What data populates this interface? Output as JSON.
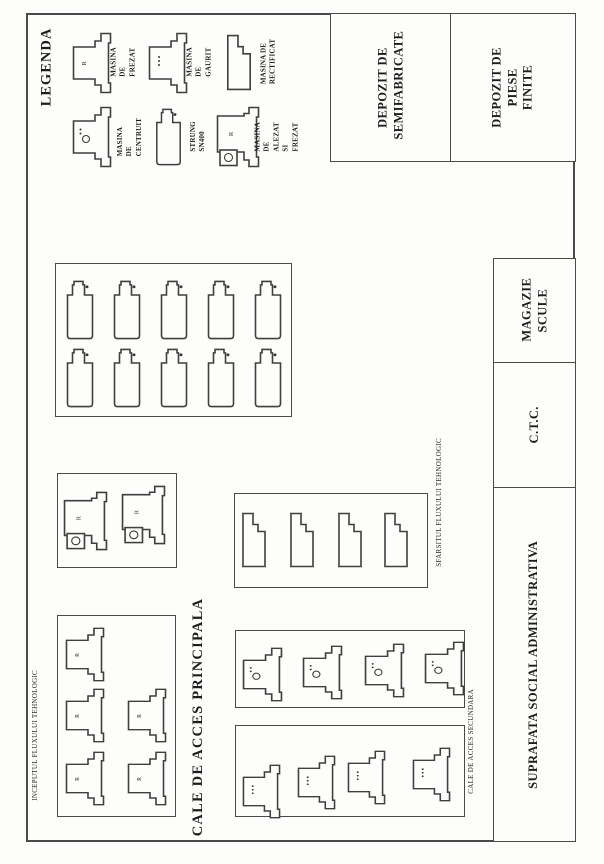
{
  "legend": {
    "title": "LEGENDA",
    "items": [
      {
        "type": "frezat",
        "label": "MASINA DE FREZAT"
      },
      {
        "type": "gaurit",
        "label": "MASINA DE GAURIT"
      },
      {
        "type": "rectificat",
        "label": "MASINA DE RECTIFICAT"
      },
      {
        "type": "centruit",
        "label": "MASINA DE CENTRUIT"
      },
      {
        "type": "strung",
        "label": "STRUNG SN400"
      },
      {
        "type": "alezat",
        "label": "MASINA DE ALEZAT SI FREZAT"
      }
    ]
  },
  "rooms": {
    "depozit_semifabricate": "DEPOZIT DE SEMIFABRICATE",
    "depozit_piese_finite": "DEPOZIT DE PIESE FINITE",
    "magazie_scule": "MAGAZIE SCULE",
    "ctc": "C.T.C.",
    "suprafata_social": "SUPRAFATA SOCIAL ADMINISTRATIVA"
  },
  "annotations": {
    "inceputul_fluxului": "INCEPUTUL FLUXULUI TEHNOLOGIC",
    "sfarsitul_fluxului": "SFARSITUL FLUXULUI TEHNOLOGIC",
    "cale_acces_principala": "CALE DE ACCES PRINCIPALA",
    "cale_acces_secundara": "CALE DE ACCES SECUNDARA"
  },
  "machine_marks": {
    "frezat": "R",
    "alezat": "R"
  },
  "machine_groups": [
    {
      "id": "strung-bay",
      "type": "strung",
      "box": [
        55,
        263,
        237,
        154
      ],
      "mw": 28,
      "mh": 60,
      "machines": [
        [
          10,
          16
        ],
        [
          57,
          16
        ],
        [
          104,
          16
        ],
        [
          151,
          16
        ],
        [
          198,
          16
        ],
        [
          10,
          84
        ],
        [
          57,
          84
        ],
        [
          104,
          84
        ],
        [
          151,
          84
        ],
        [
          198,
          84
        ]
      ]
    },
    {
      "id": "alezat-bay",
      "type": "alezat",
      "box": [
        57,
        473,
        120,
        95
      ],
      "mw": 45,
      "mh": 60,
      "machines": [
        [
          5,
          17
        ],
        [
          63,
          11
        ]
      ]
    },
    {
      "id": "frezat-bay",
      "type": "frezat",
      "box": [
        57,
        615,
        119,
        202
      ],
      "mw": 40,
      "mh": 55,
      "machines": [
        [
          7,
          11
        ],
        [
          7,
          72
        ],
        [
          7,
          135
        ],
        [
          69,
          72
        ],
        [
          69,
          135
        ]
      ]
    },
    {
      "id": "rectificat-bay",
      "type": "rectificat",
      "box": [
        234,
        493,
        194,
        95
      ],
      "mw": 26,
      "mh": 56,
      "machines": [
        [
          6,
          18
        ],
        [
          54,
          18
        ],
        [
          102,
          18
        ],
        [
          148,
          18
        ]
      ]
    },
    {
      "id": "centruit-bay",
      "type": "centruit",
      "box": [
        235,
        630,
        230,
        78
      ],
      "mw": 41,
      "mh": 55,
      "machines": [
        [
          6,
          16
        ],
        [
          66,
          14
        ],
        [
          128,
          12
        ],
        [
          188,
          10
        ]
      ]
    },
    {
      "id": "gaurit-bay",
      "type": "gaurit",
      "box": [
        235,
        725,
        230,
        92
      ],
      "mw": 39,
      "mh": 55,
      "machines": [
        [
          6,
          38
        ],
        [
          61,
          29
        ],
        [
          111,
          24
        ],
        [
          176,
          21
        ]
      ]
    }
  ]
}
